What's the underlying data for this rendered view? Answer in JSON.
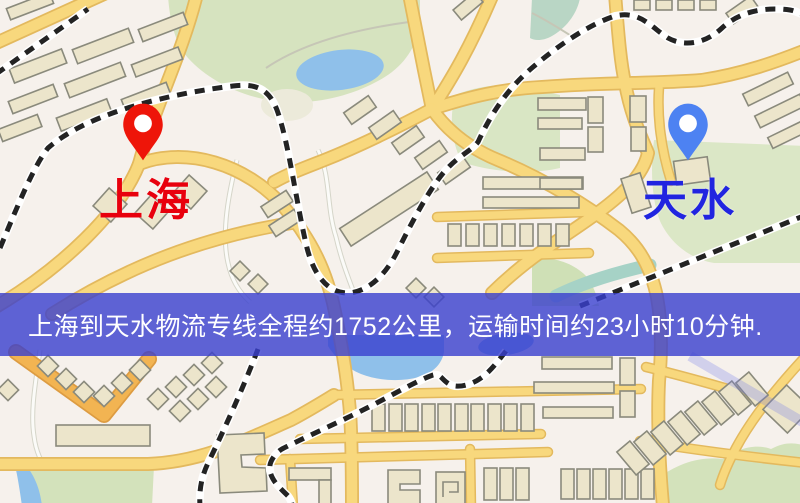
{
  "map": {
    "origin": {
      "label": "上海",
      "label_color": "#e8000d",
      "pin_color": "#ee1509",
      "pin_icon": "map-pin"
    },
    "destination": {
      "label": "天水",
      "label_color": "#2125e0",
      "pin_color": "#4d82f2",
      "pin_icon": "map-pin"
    },
    "banner": {
      "text": "上海到天水物流专线全程约1752公里，运输时间约23小时10分钟.",
      "background_color": "rgba(56,62,206,0.8)",
      "text_color": "#ffffff"
    },
    "route": {
      "origin": "上海",
      "destination": "天水",
      "distance_km": 1752,
      "duration_hours": 23,
      "duration_minutes": 10
    },
    "palette": {
      "land": "#f6f1ec",
      "road_fill": "#f8d87d",
      "road_casing": "#e3b95e",
      "highway_orange": "#f2b452",
      "park_green": "#d6e3bf",
      "water_blue": "#8fc0ea",
      "building_fill": "#ece5cb",
      "building_outline": "#8a8a7c",
      "railway_dark": "#232323"
    }
  }
}
